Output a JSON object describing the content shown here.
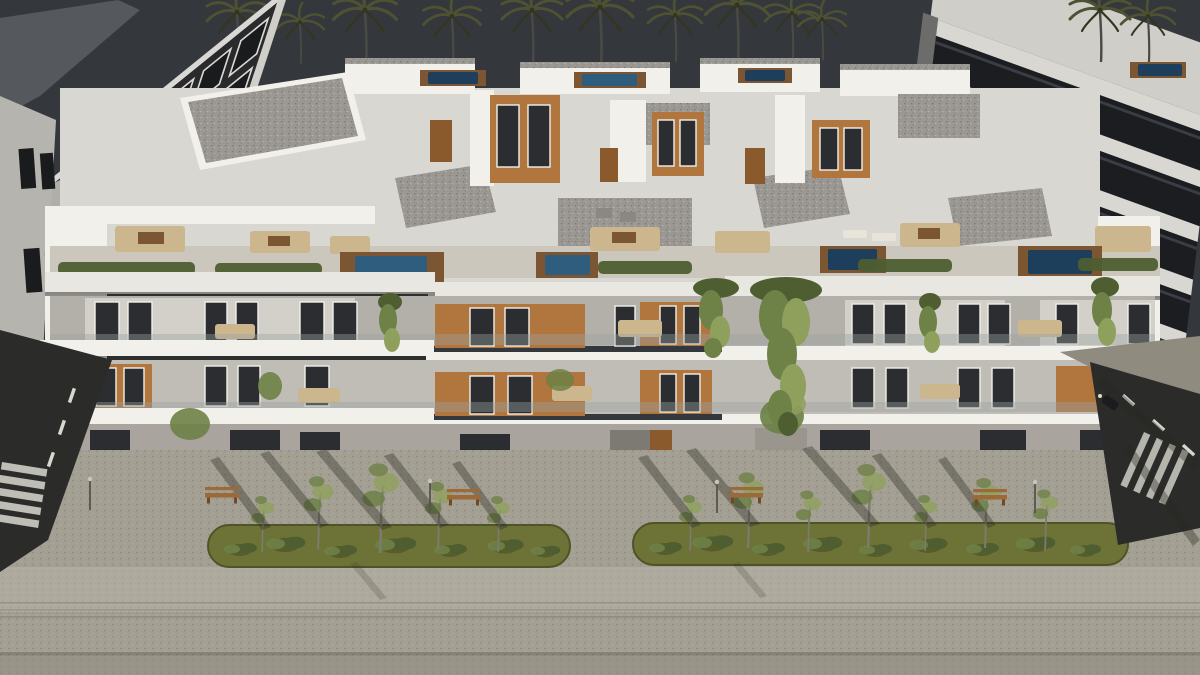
{
  "scene": {
    "type": "architectural-render",
    "sky": "dark dusk sky with palm tree silhouettes",
    "background": {
      "palm_tree_count": 14,
      "left_building": "dark facade apartment block with white window frames",
      "right_building": "white slab building with dark glass balcony bands"
    },
    "main_building": {
      "style": "modern white apartment block, aerial front view",
      "balcony_floors_visible": 2,
      "rooftop": "penthouse volumes, gravel roofs, terraces with furniture, hedges and plunge pools",
      "rooftop_pool_count": 8,
      "features": [
        "wood panel accents",
        "climbing green vines",
        "glass balustrades",
        "ground floor entrances"
      ]
    },
    "street": {
      "green_island_count": 2,
      "bench_count": 4,
      "lamp_post_count": 4,
      "crosswalk_count": 2,
      "parked_scooter_count": 1,
      "surfaces": [
        "paved promenade",
        "asphalt side roads",
        "striped lower walkway"
      ]
    }
  },
  "palette": {
    "sky": "#34373c",
    "palm_frond": "#4e5132",
    "palm_frond_dark": "#33351f",
    "palm_trunk": "#4a4a44",
    "left_bldg_facade": "#2a2a2c",
    "left_bldg_frame": "#d9d8d4",
    "left_bldg_glass": "#1a1b1d",
    "side_wall_light": "#b6b4ae",
    "right_bldg_slab": "#d8d7d2",
    "right_bldg_glass": "#1b1d21",
    "right_bldg_roof": "#cfcec9",
    "white_facade": "#e9e7e1",
    "white_bright": "#f2f0ea",
    "white_shadow": "#c4c1ba",
    "recess_shadow": "#b3b0a9",
    "terrace_floor": "#cbc7bd",
    "wood_panel": "#b0763d",
    "wood_panel_dark": "#8a5a2c",
    "window_glass": "#2b2d30",
    "roof_gravel": "#9b9893",
    "hedge_green": "#4e5e31",
    "vine_green": "#6e8147",
    "vine_green_light": "#8fa05c",
    "grass": "#6d7337",
    "grass_dark": "#565c2a",
    "pool_blue": "#2f5d7e",
    "pool_blue_dark": "#1e3f5c",
    "deck_wood": "#7c5533",
    "furniture_beige": "#cbb68d",
    "paving": "#a39f93",
    "paving_light": "#aeaa9e",
    "paving_dark": "#8f8b7f",
    "paving_darker": "#7e7a6e",
    "asphalt": "#2b2b29",
    "road_marking": "#d8d7cf",
    "bench_wood": "#9c6a38",
    "bench_wood_dark": "#6e4a26",
    "shadow_tint": "rgba(38,38,32,0.35)",
    "curb": "#6e6a60"
  }
}
